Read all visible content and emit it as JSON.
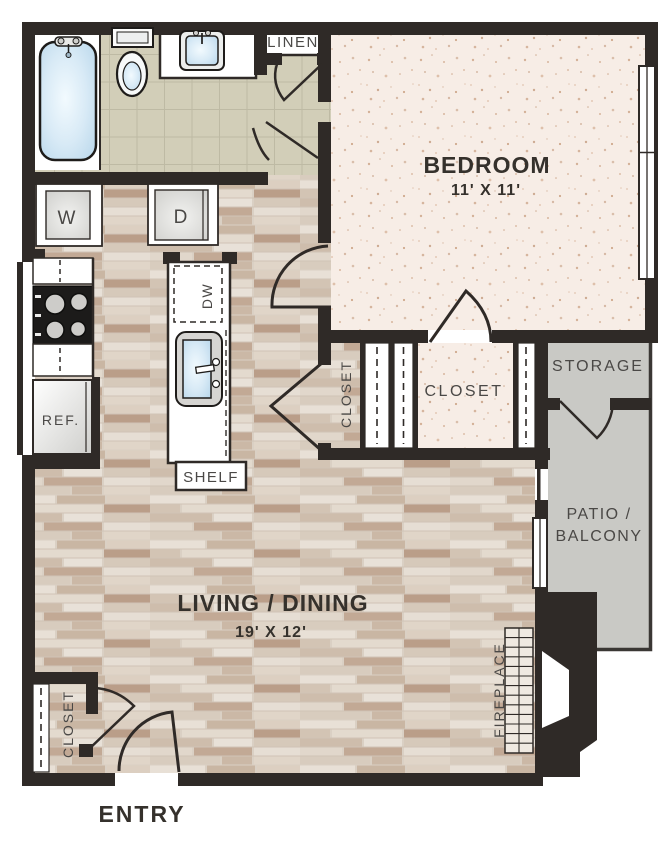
{
  "rooms": {
    "bedroom": {
      "label": "BEDROOM",
      "dimensions": "11' X 11'"
    },
    "living_dining": {
      "label": "LIVING / DINING",
      "dimensions": "19' X 12'"
    },
    "entry": {
      "label": "ENTRY"
    },
    "linen": {
      "label": "LINEN"
    },
    "storage": {
      "label": "STORAGE"
    },
    "patio_balcony": {
      "label_line1": "PATIO /",
      "label_line2": "BALCONY"
    },
    "bedroom_closet": {
      "label": "CLOSET"
    },
    "hall_closet": {
      "label": "CLOSET"
    },
    "entry_closet": {
      "label": "CLOSET"
    }
  },
  "fixtures": {
    "washer": {
      "label": "W"
    },
    "dryer": {
      "label": "D"
    },
    "dishwasher": {
      "label": "DW"
    },
    "refrigerator": {
      "label": "REF."
    },
    "shelf": {
      "label": "SHELF"
    },
    "fireplace": {
      "label": "FIREPLACE"
    }
  },
  "colors": {
    "wall": "#2F2A27",
    "bathroom_tile": "#D2CEB8",
    "tile_grout": "#BEBAA4",
    "carpet": "#F7EDE6",
    "carpet_speckle": "#C59877",
    "wood_floor": "#DAD0C4",
    "patio_concrete": "#C9C9C5",
    "water_fixture": "#CFE5F3",
    "label_dark": "#35312C",
    "label_light": "#4A4846"
  }
}
